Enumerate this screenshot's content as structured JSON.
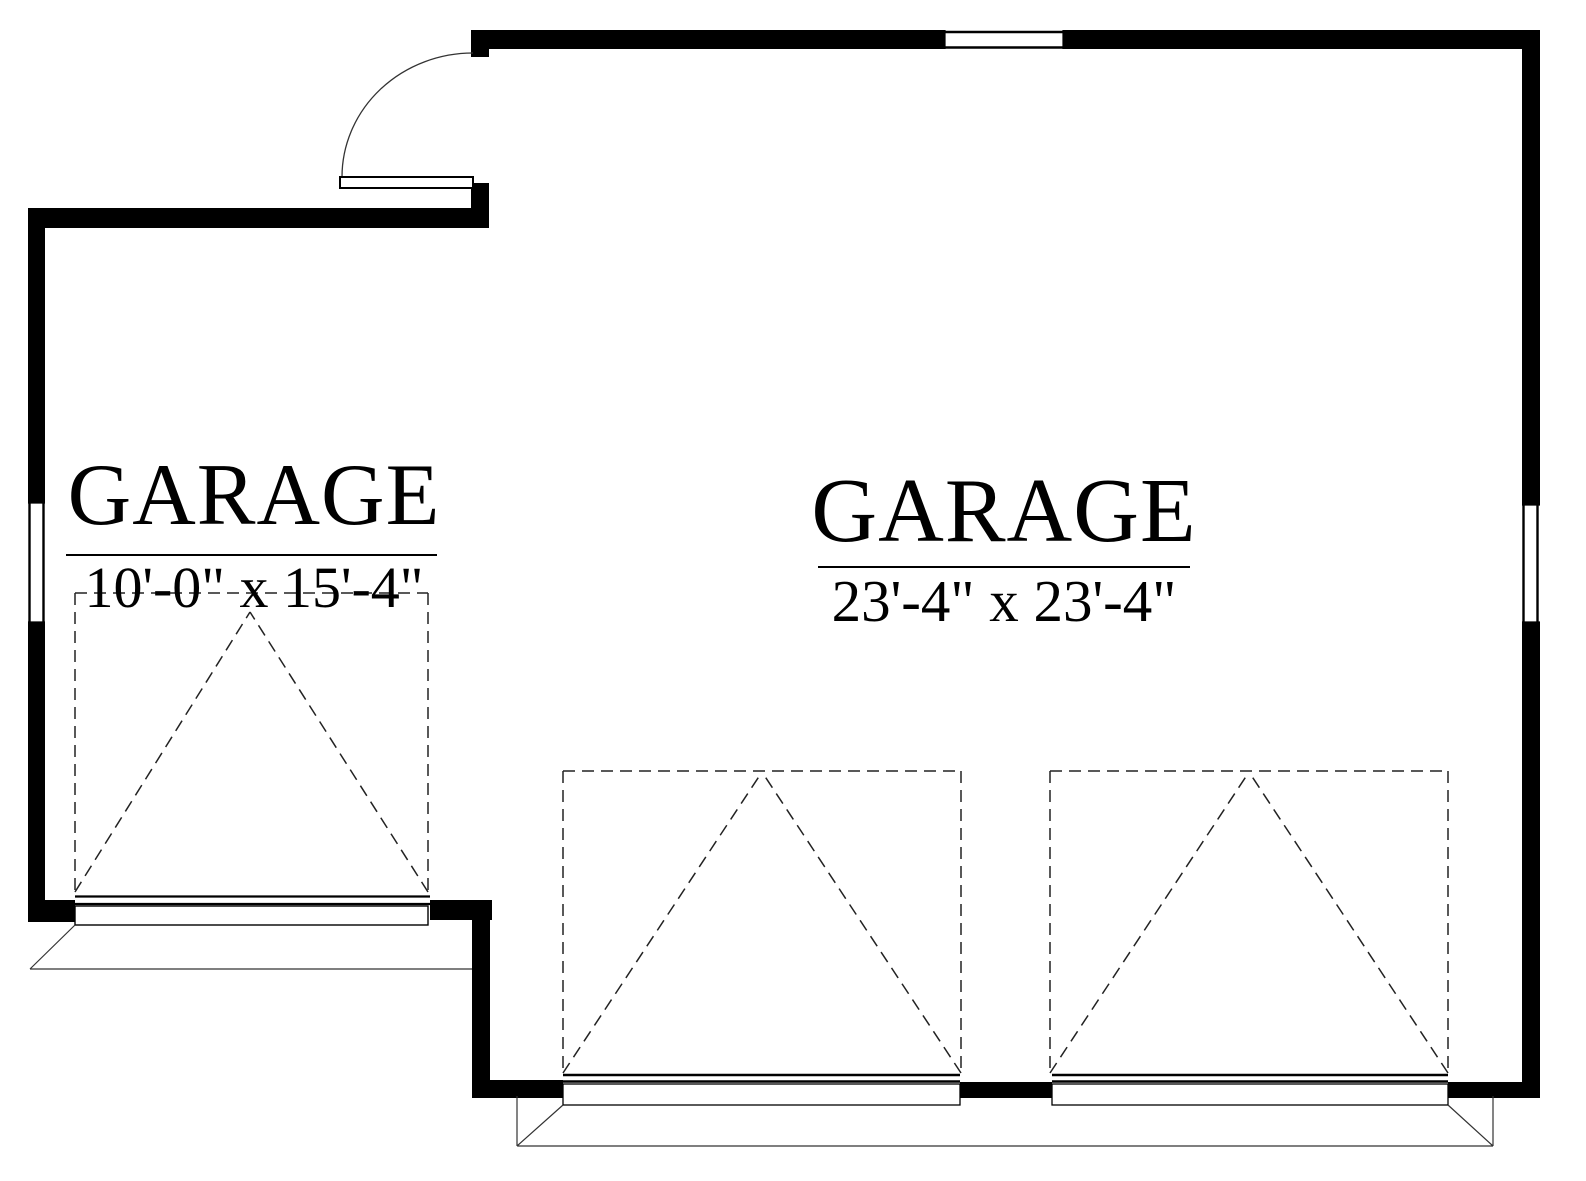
{
  "rooms": [
    {
      "id": "small-garage",
      "label": "GARAGE",
      "dimensions": "10'-0\" x 15'-4\""
    },
    {
      "id": "large-garage",
      "label": "GARAGE",
      "dimensions": "23'-4\" x 23'-4\""
    }
  ],
  "symbols": {
    "entry_door": "swing-door",
    "garage_doors": "overhead-door-dashed-swing",
    "windows": "wall-window-break"
  },
  "colors": {
    "background": "#ffffff",
    "wall": "#000000",
    "thin_line": "#1a1a1a",
    "dashed_line": "#222222"
  }
}
